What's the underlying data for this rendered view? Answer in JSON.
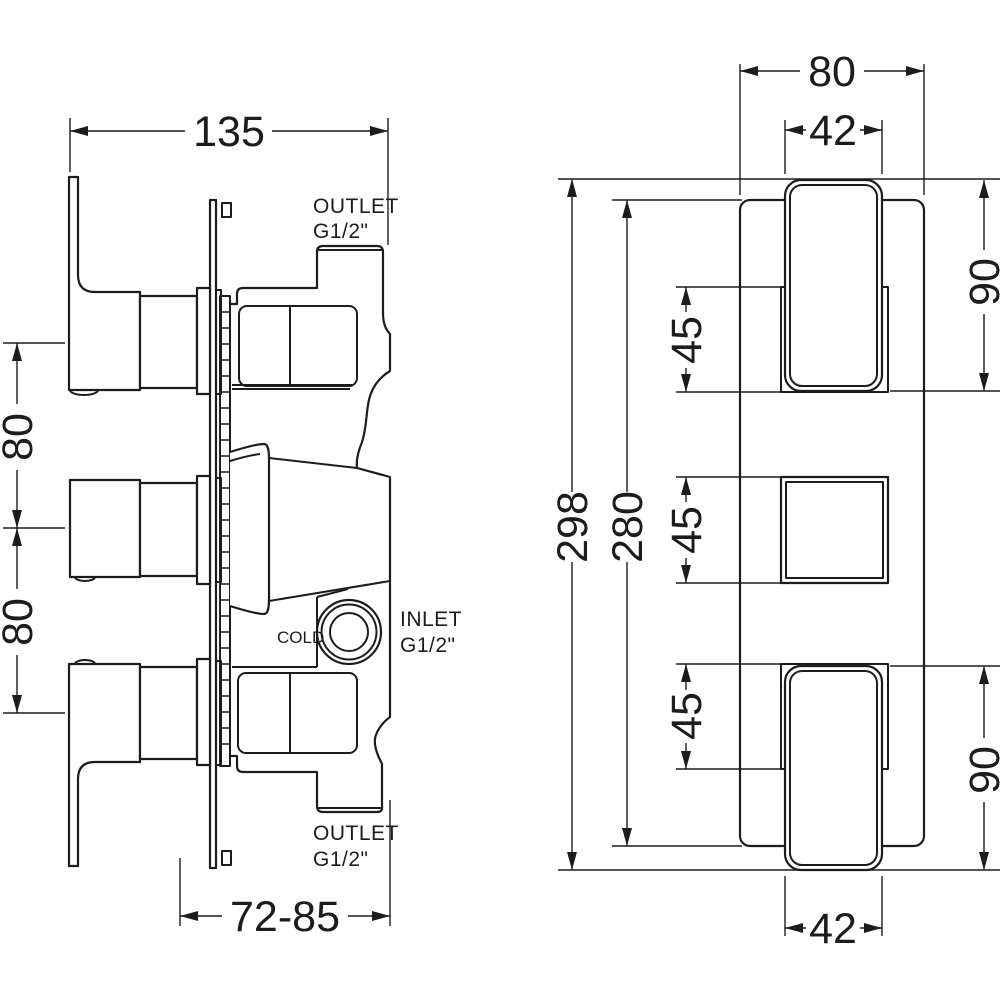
{
  "side_view": {
    "dims": {
      "width": "135",
      "handle_spacing_upper": "80",
      "handle_spacing_lower": "80",
      "depth_range": "72-85"
    },
    "labels": {
      "outlet_top_1": "OUTLET",
      "outlet_top_2": "G1/2\"",
      "inlet_1": "INLET",
      "inlet_2": "G1/2\"",
      "cold": "COLD",
      "outlet_bottom_1": "OUTLET",
      "outlet_bottom_2": "G1/2\""
    }
  },
  "front_view": {
    "dims": {
      "plate_width": "80",
      "knob_width_top": "42",
      "knob_height_top": "90",
      "cutout_top": "45",
      "cutout_middle": "45",
      "cutout_bottom": "45",
      "overall_height": "298",
      "plate_height": "280",
      "knob_height_bottom": "90",
      "knob_width_bottom": "42"
    }
  },
  "colors": {
    "ink": "#1c1c1c",
    "background": "#ffffff"
  }
}
